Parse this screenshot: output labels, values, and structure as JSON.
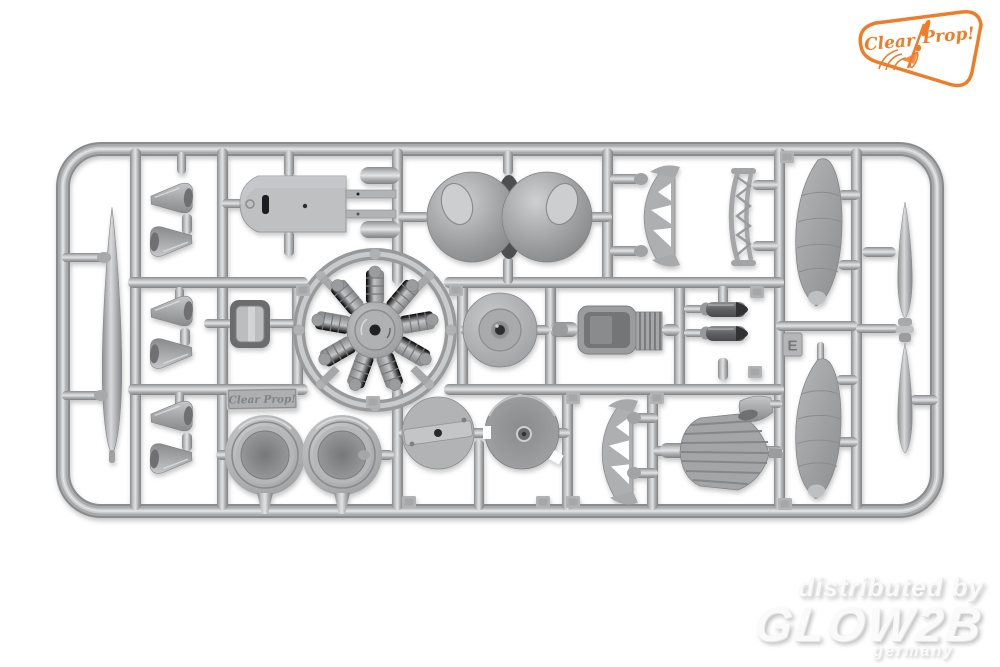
{
  "photo": {
    "subject": "plastic model kit sprue with aircraft parts on white background",
    "background_color": "#ffffff",
    "plastic_color": "#b4b5b7",
    "plastic_highlight": "#e2e3e5",
    "plastic_shadow": "#818284"
  },
  "sprue": {
    "letter_tag": "E",
    "molded_plate_text": "Clear Prop!",
    "part_shapes": [
      "propeller-blade",
      "exhaust-cones",
      "cockpit-deck",
      "cowling-domes",
      "girder-strut",
      "ladder-strut",
      "radial-engine",
      "radiator-box",
      "bullet-exhausts",
      "float-panel",
      "spinner-hub",
      "cowl-ring-wheels",
      "firewall-disc",
      "cowl-bowl",
      "louvered-cowl",
      "intake-scoop"
    ]
  },
  "brand_badge": {
    "word1": "Clear",
    "word2": "Prop!",
    "accent_color": "#ee7d2a",
    "icon": "propeller-icon"
  },
  "watermark": {
    "line1": "distributed by",
    "line2": "GLOW2B",
    "line3": "germany",
    "text_color": "#fafafa",
    "shadow_color": "#bfbfbf"
  }
}
